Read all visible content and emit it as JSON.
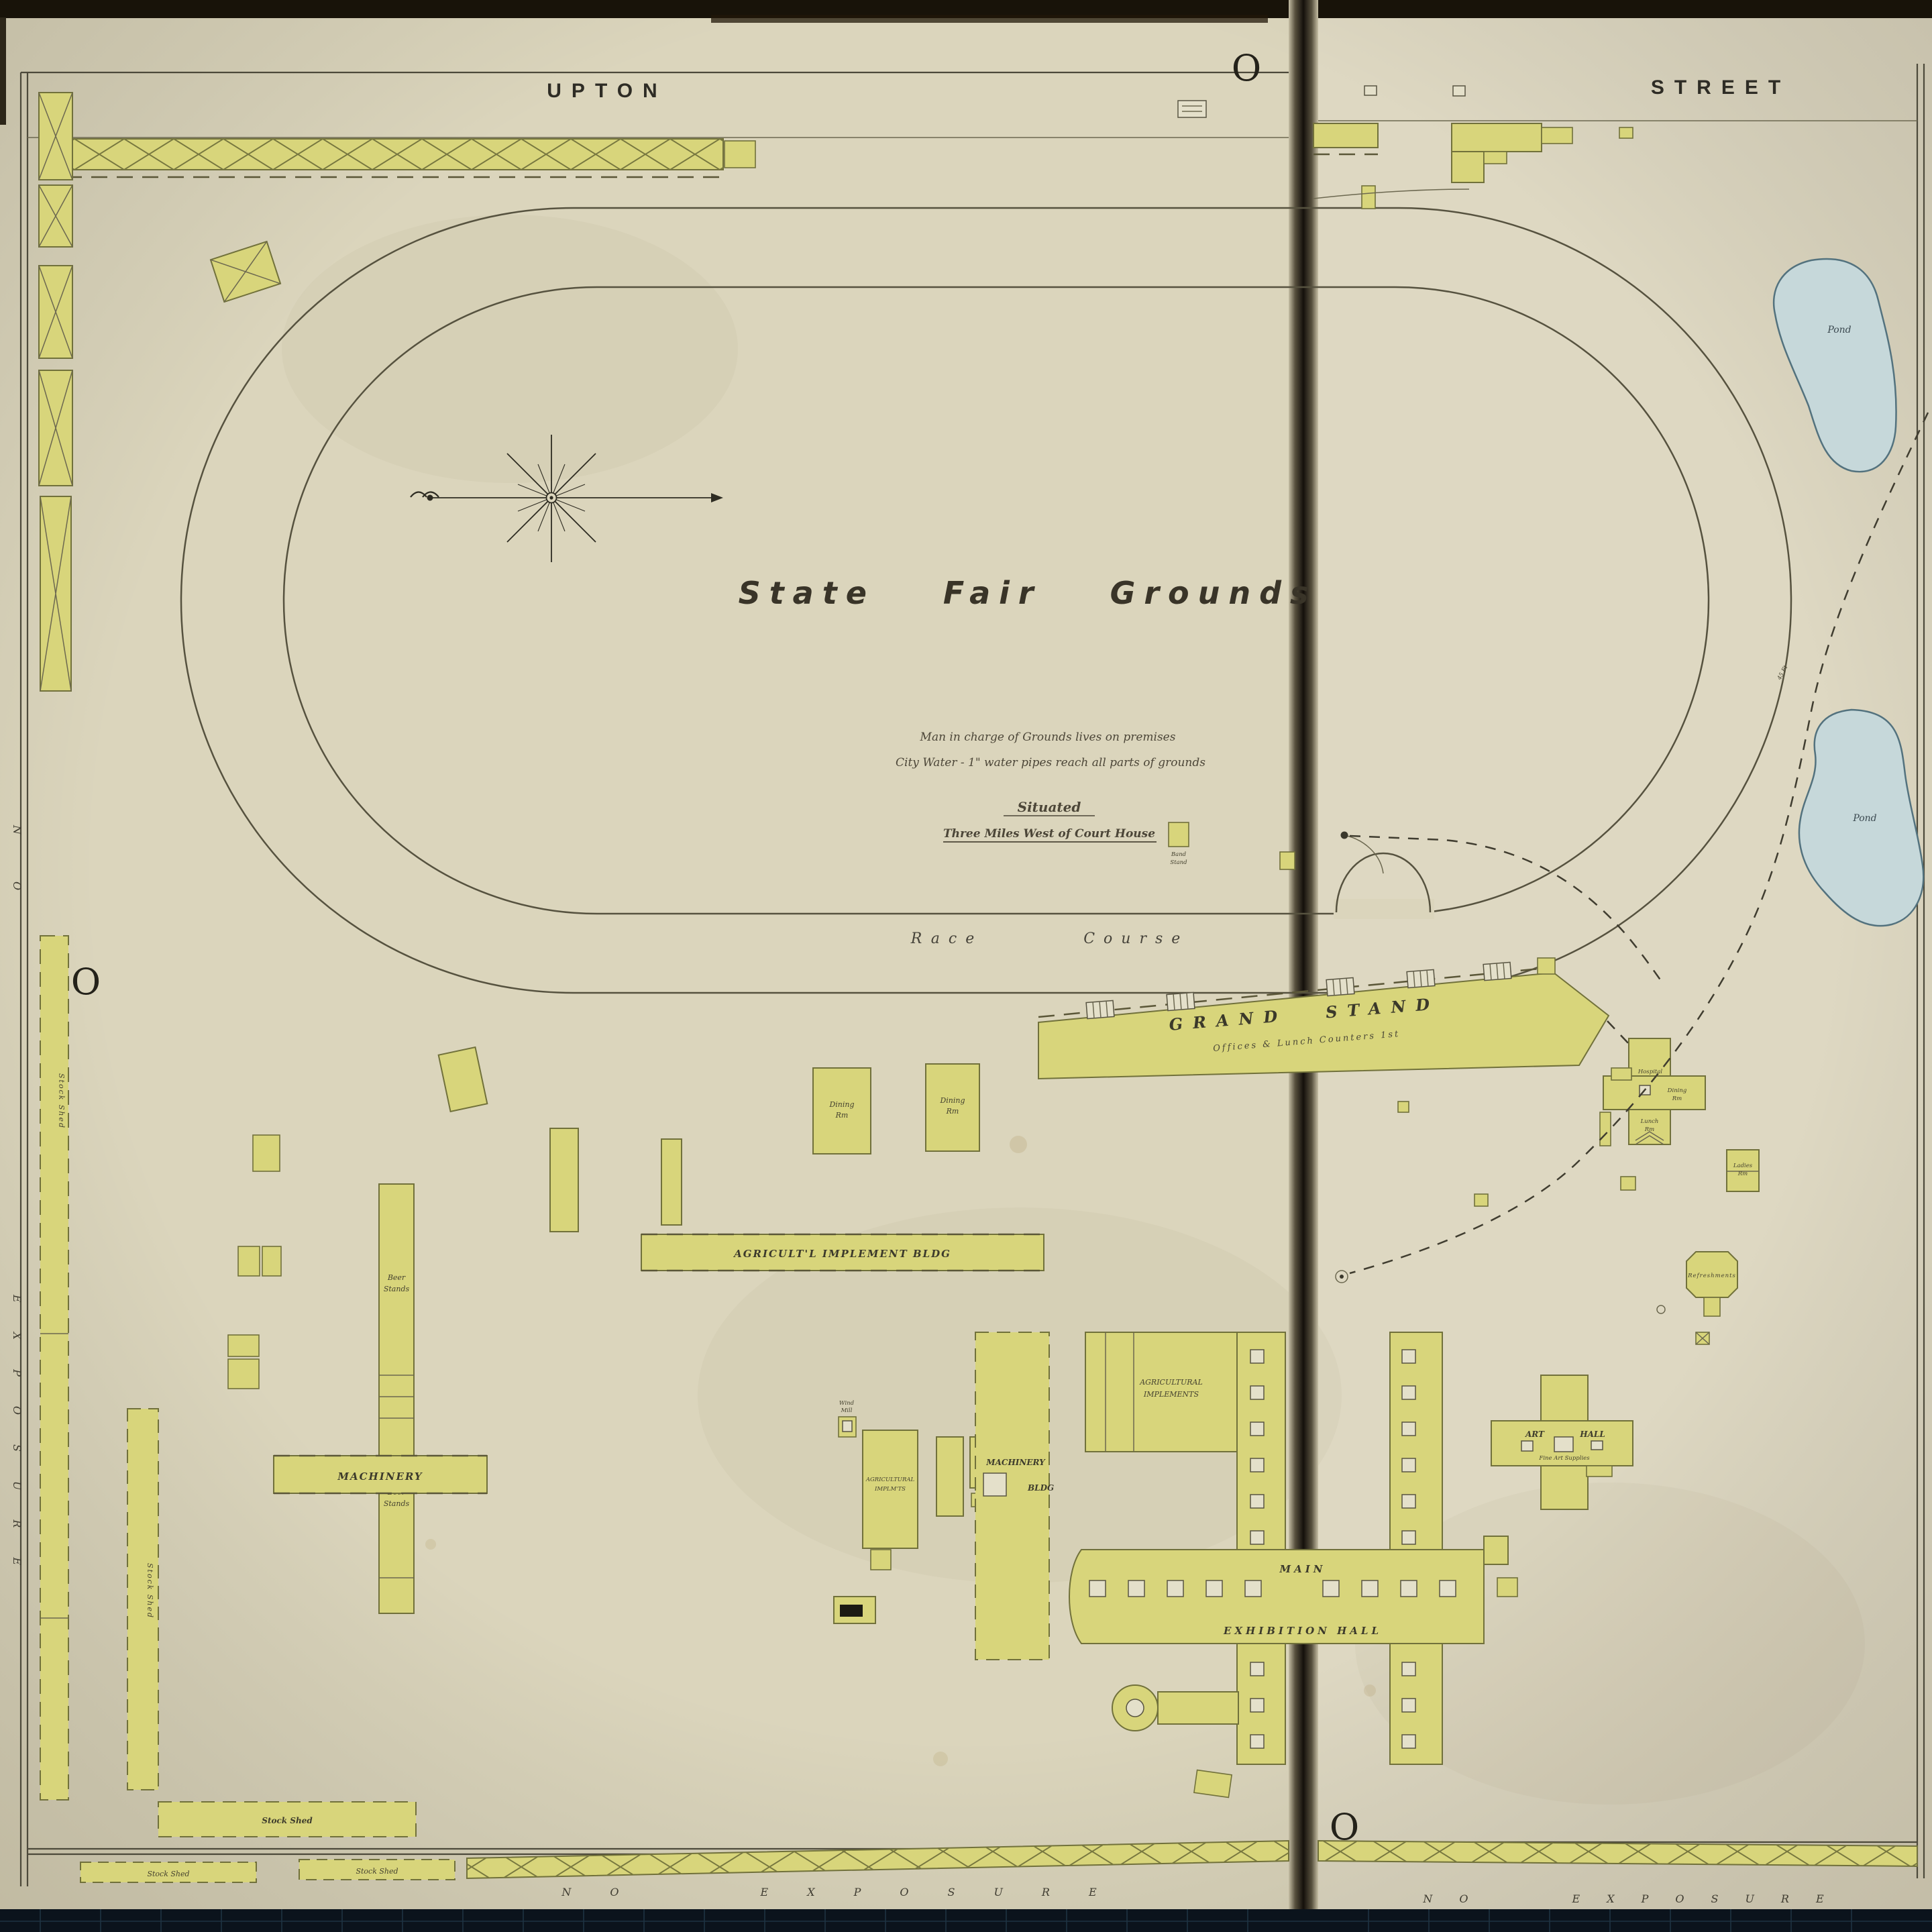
{
  "page": {
    "street_left": "UPTON",
    "street_right": "STREET",
    "plate_letter": "O",
    "no_exposure": "NO EXPOSURE",
    "no_word": "NO",
    "exposure_word": "EXPOSURE"
  },
  "title": {
    "text": "State Fair Grounds",
    "note1": "Man in charge of Grounds lives on premises",
    "note2": "City Water - 1\" water pipes reach all parts of grounds",
    "situated": "Situated",
    "situated_sub": "Three Miles West of Court House"
  },
  "track": {
    "race_course": "Race Course",
    "band_stand_1": "Band",
    "band_stand_2": "Stand"
  },
  "buildings": {
    "grand_stand": "GRAND STAND",
    "grand_stand_sub": "Offices & Lunch Counters 1st",
    "agl_implement_bldg": "AGRICULT'L  IMPLEMENT  BLDG",
    "machinery": "MACHINERY",
    "machinery_bldg_1": "MACHINERY",
    "machinery_bldg_2": "BLDG",
    "agric_impl_1": "AGRICULTURAL",
    "agric_impl_2": "IMPLEMENTS",
    "agric_small_1": "AGRICULTURAL",
    "agric_small_2": "IMPLM'TS",
    "main": "MAIN",
    "exhibition_hall": "EXHIBITION HALL",
    "art": "ART",
    "hall": "HALL",
    "art_hall_sub": "Fine Art Supplies",
    "dining_1": "Dining",
    "dining_2": "Rm",
    "beer_1": "Beer",
    "beer_2": "Stands",
    "stock_shed": "Stock Shed",
    "hospital": "Hospital",
    "lunch_1": "Lunch",
    "lunch_2": "Rm",
    "ladies_1": "Ladies",
    "ladies_2": "Rm",
    "wind_1": "Wind",
    "wind_2": "Mill",
    "refreshments": "Refreshments",
    "pond": "Pond"
  },
  "annotations": {
    "forty_five_ft": "45 Ft"
  },
  "colors": {
    "paper": "#dbd5bc",
    "building_fill": "#d8d57b",
    "building_stroke": "#71713b",
    "ink": "#3a382c",
    "pond_fill": "#c6d8da",
    "pond_stroke": "#53727e",
    "seam_dark": "#14100b",
    "mat": "#0b131c",
    "top_band": "#181309"
  }
}
